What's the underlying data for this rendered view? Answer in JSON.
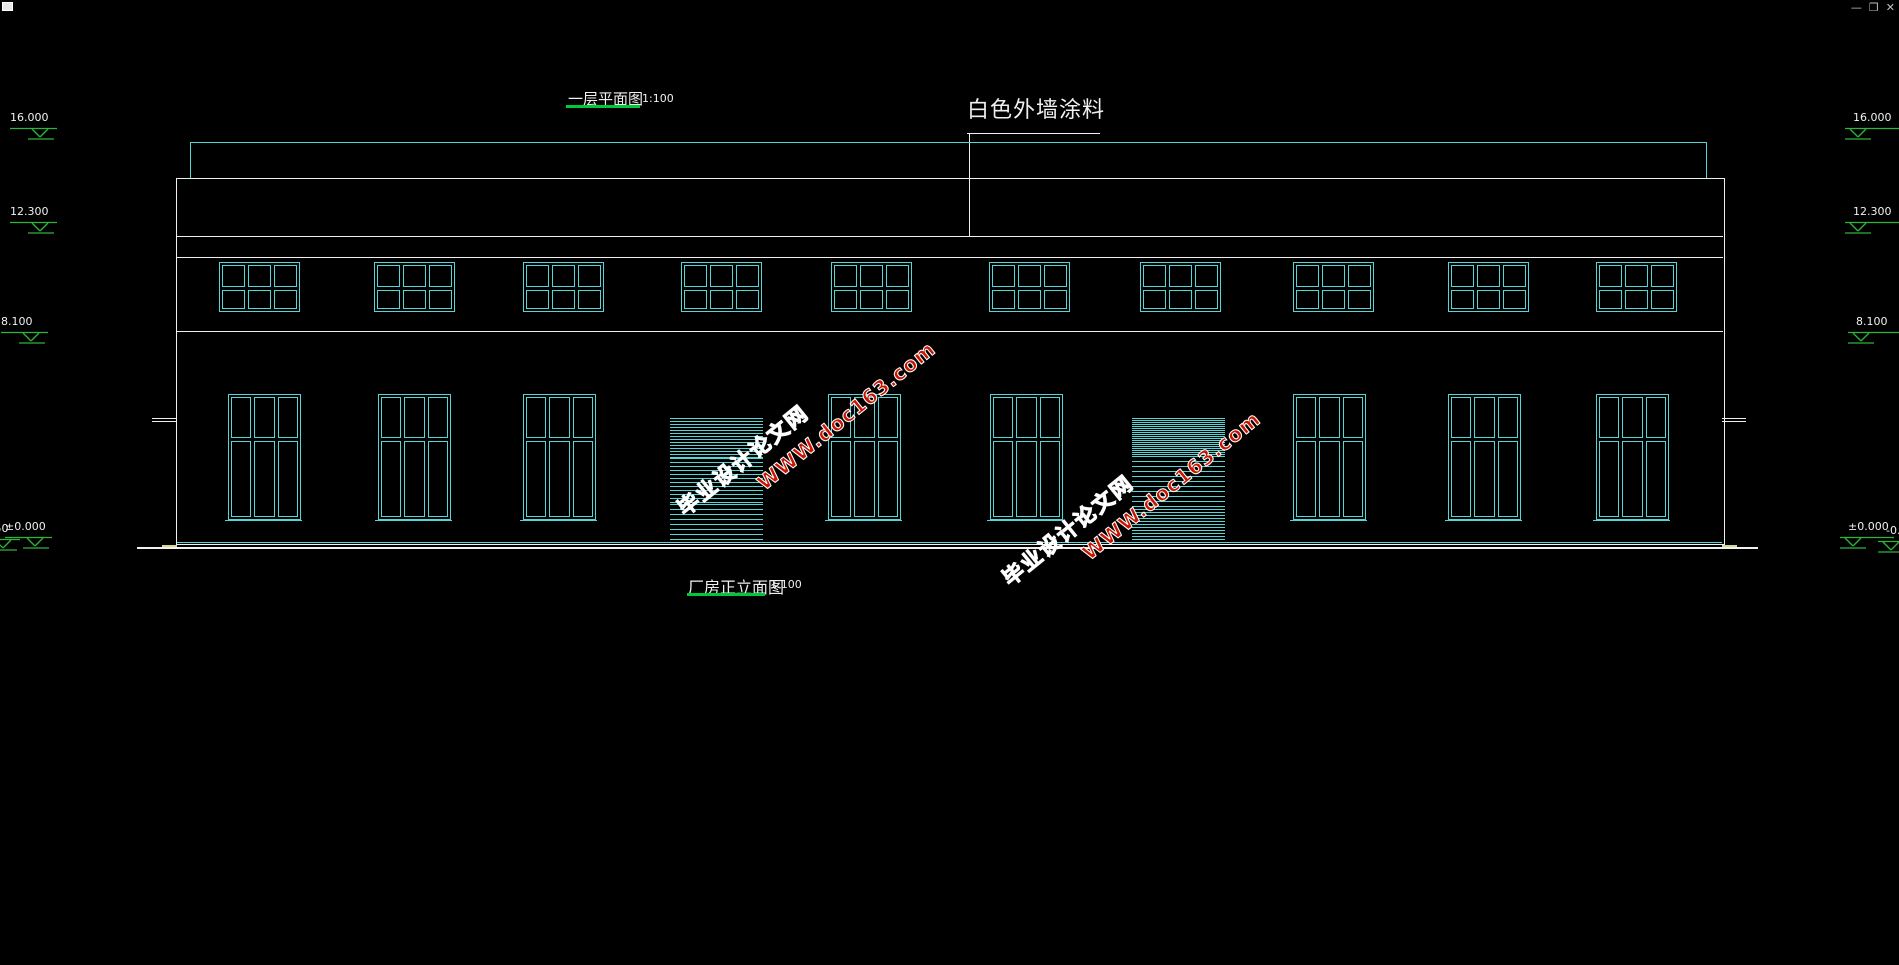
{
  "window_controls": {
    "minimize": "—",
    "restore": "❐",
    "close": "✕"
  },
  "titles": {
    "plan": {
      "text": "一层平面图",
      "scale": "1:100"
    },
    "elevation": {
      "text": "厂房正立面图",
      "scale": "1:100"
    },
    "wall_finish_label": "白色外墙涂料"
  },
  "watermark": {
    "line1": "毕业设计论文网",
    "line2": "WWW.doc163.com",
    "color": "#c81400",
    "instances": [
      {
        "left": 660,
        "top": 408,
        "angle": -39
      },
      {
        "left": 985,
        "top": 478,
        "angle": -39
      }
    ]
  },
  "levels": {
    "left": [
      {
        "label": "16.000",
        "x": 10,
        "line_y": 128
      },
      {
        "label": "12.300",
        "x": 10,
        "line_y": 222
      },
      {
        "label": "8.100",
        "x": 1,
        "line_y": 332
      },
      {
        "label": "±0.000",
        "x": 5,
        "line_y": 537
      },
      {
        "label": "-0.450",
        "x": -27,
        "line_y": 539
      }
    ],
    "right": [
      {
        "label": "16.000",
        "x": 1845,
        "line_y": 128
      },
      {
        "label": "12.300",
        "x": 1845,
        "line_y": 222
      },
      {
        "label": "8.100",
        "x": 1848,
        "line_y": 332
      },
      {
        "label": "±0.000",
        "x": 1840,
        "line_y": 537
      },
      {
        "label": "-0.450",
        "x": 1878,
        "line_y": 541
      }
    ]
  },
  "colors": {
    "cyan": "#54d6d6",
    "marker_green": "#2db53a",
    "underline_green": "#00c83c",
    "white": "#f0f0f0",
    "red": "#c81400",
    "yellow": "#d6d68e",
    "icon_gray": "#c0c0c0"
  },
  "geometry": {
    "building": {
      "left": 176,
      "top": 178,
      "right": 1723,
      "bottom": 543
    },
    "parapet": {
      "x1": 190,
      "x2": 1706,
      "y": 142,
      "drop_to": 178
    },
    "band_lines": [
      236,
      257,
      331
    ],
    "base_cyan": {
      "y": 542,
      "x1": 177,
      "x2": 1722
    },
    "ground": {
      "y": 547,
      "h": 2,
      "x1": 137,
      "x2": 1758
    },
    "corner_chamfers": [
      {
        "x": 162,
        "y": 545,
        "w": 15
      },
      {
        "x": 1722,
        "y": 545,
        "w": 15
      }
    ],
    "side_ticks": {
      "ys": [
        418,
        421
      ],
      "left_x": 152,
      "right_x": 1722,
      "w": 24
    },
    "upper_windows": {
      "y": 262,
      "h": 48,
      "w": 79,
      "rows": 2,
      "cols": 3,
      "transom_frac": 0.5,
      "xs": [
        219,
        374,
        523,
        681,
        831,
        989,
        1140,
        1293,
        1448,
        1596
      ]
    },
    "ground_windows": {
      "y": 394,
      "h": 124,
      "rows": 2,
      "cols": 3,
      "transom_frac": 0.34,
      "xs": [
        228,
        378,
        523,
        828,
        990,
        1293,
        1448,
        1596
      ],
      "w": 71
    },
    "doors": [
      {
        "x": 670,
        "y": 418,
        "w": 93,
        "h": 125,
        "bands": [
          {
            "h": 40,
            "period": 3
          },
          {
            "h": 46,
            "period": 4
          },
          {
            "h": 39,
            "period": 5
          }
        ]
      },
      {
        "x": 1132,
        "y": 418,
        "w": 93,
        "h": 125,
        "bands": [
          {
            "h": 38,
            "period": 2
          },
          {
            "h": 50,
            "period": 5
          },
          {
            "h": 37,
            "period": 3
          }
        ]
      }
    ]
  }
}
